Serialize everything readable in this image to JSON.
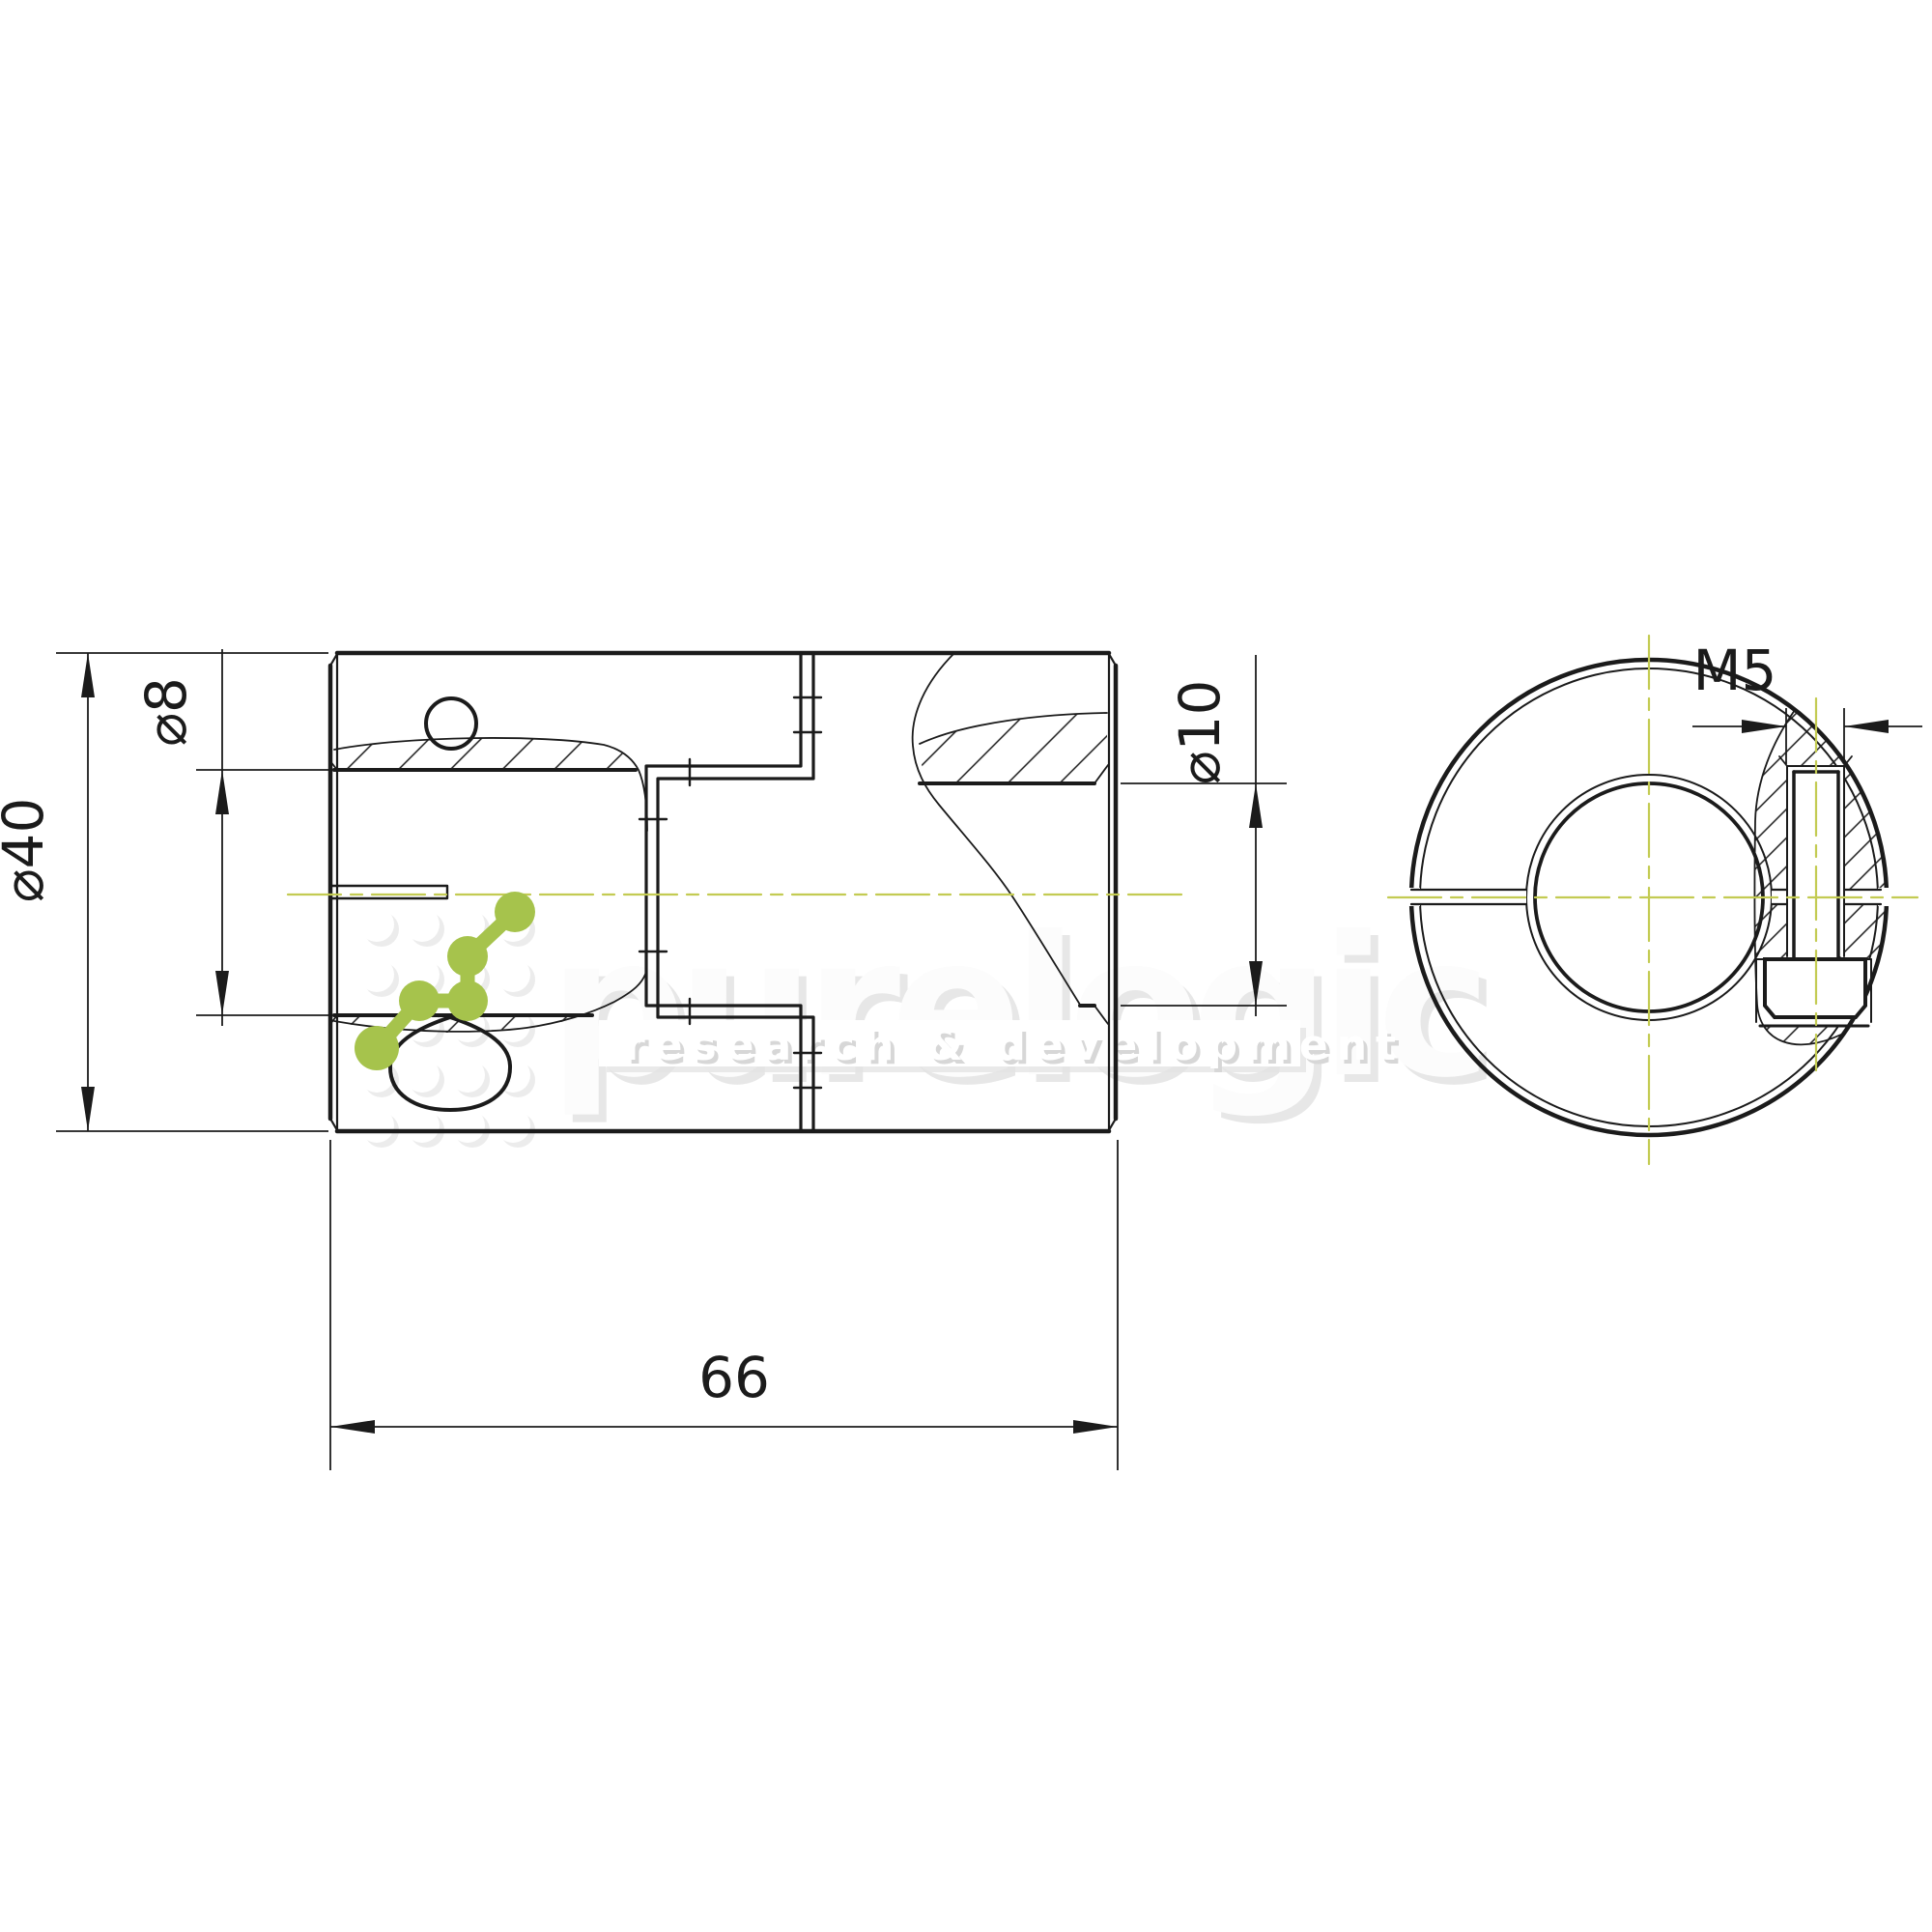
{
  "drawing": {
    "type": "technical-drawing",
    "part": "jaw shaft coupling, sectioned side view and end view",
    "dimensions": {
      "overall_diameter": "⌀40",
      "left_bore": "⌀8",
      "right_bore": "⌀10",
      "length": "66",
      "clamp_screw_thread": "M5"
    },
    "watermark": {
      "brand": "purelogic",
      "tagline": "research & development"
    },
    "colors": {
      "line": "#1b1b1b",
      "centerline": "#c3cb52",
      "brand_green": "#a6c34c",
      "watermark_gray": "#e9e9e9"
    }
  }
}
